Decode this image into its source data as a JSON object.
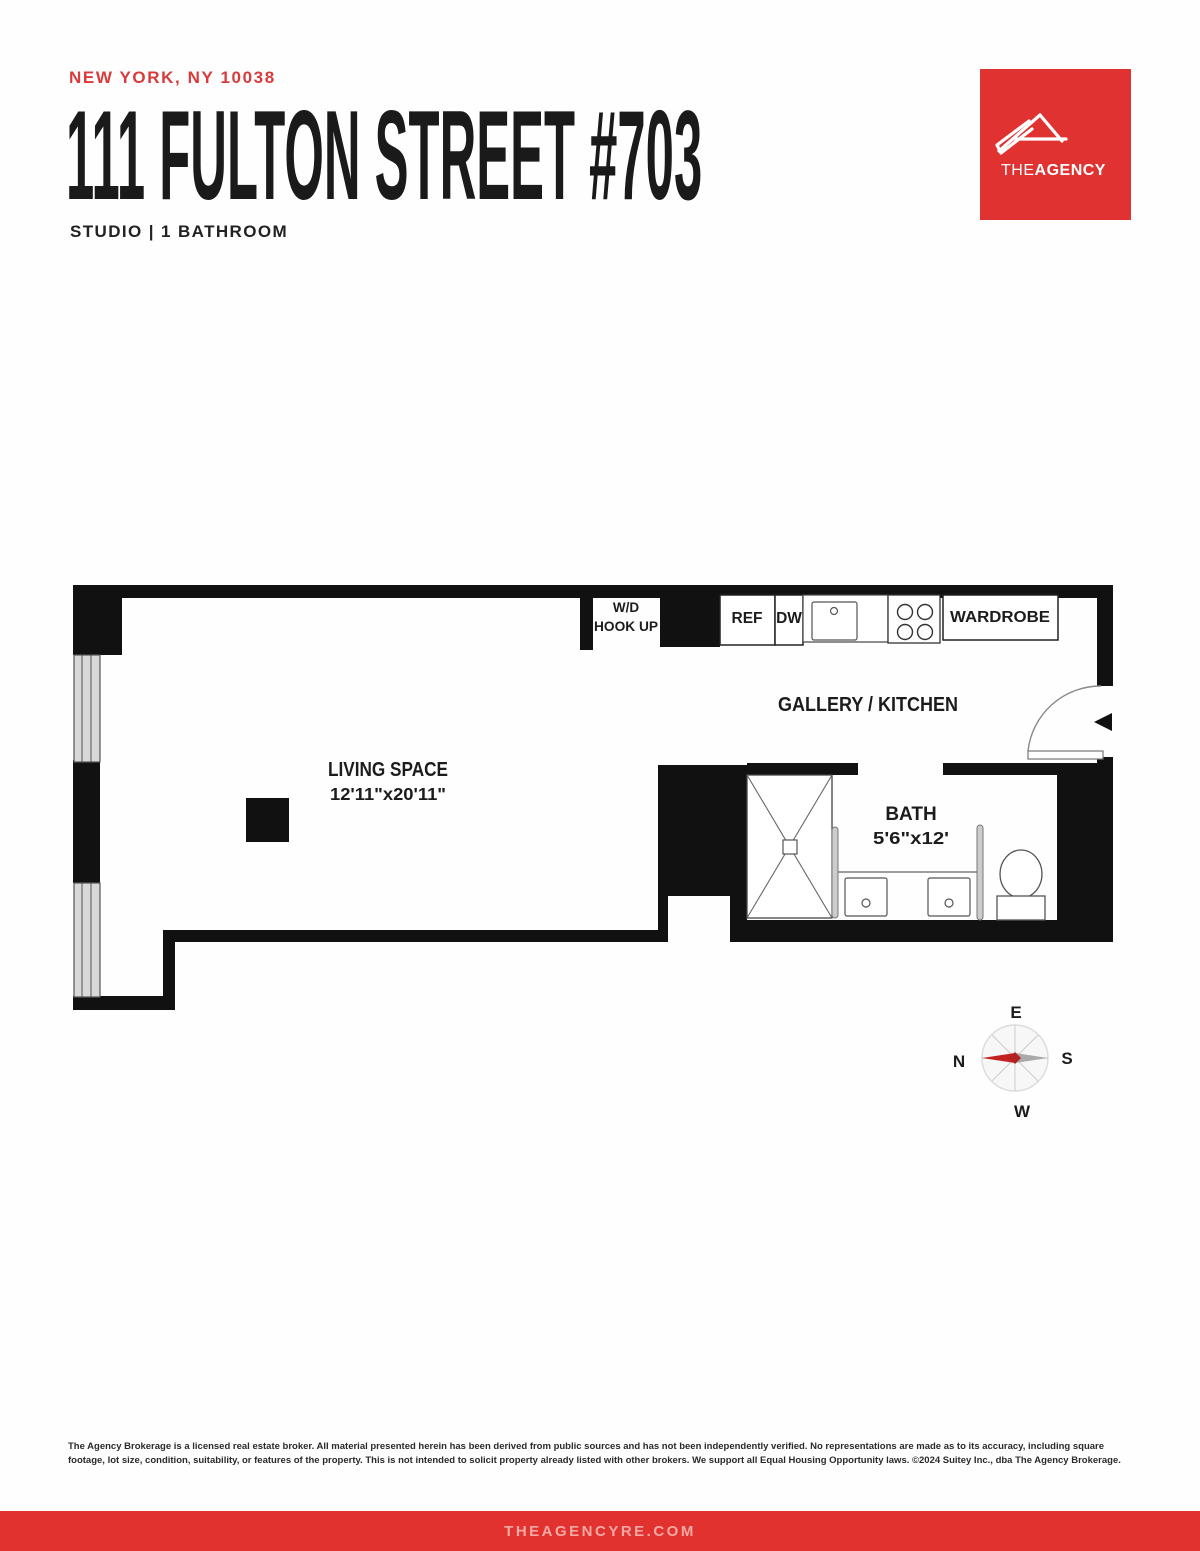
{
  "header": {
    "location": "NEW YORK, NY 10038",
    "title": "111 FULTON STREET #703",
    "subtitle": "STUDIO | 1 BATHROOM"
  },
  "logo": {
    "brand_the": "THE",
    "brand_agency": "AGENCY"
  },
  "floorplan": {
    "labels": {
      "wd_line1": "W/D",
      "wd_line2": "HOOK UP",
      "ref": "REF",
      "dw": "DW",
      "wardrobe": "WARDROBE",
      "gallery_kitchen": "GALLERY / KITCHEN",
      "living_space": "LIVING SPACE",
      "living_dims": "12'11\"x20'11\"",
      "bath": "BATH",
      "bath_dims": "5'6\"x12'"
    },
    "compass": {
      "north": "N",
      "east": "E",
      "south": "S",
      "west": "W"
    }
  },
  "disclaimer": "The Agency Brokerage is a licensed real estate broker. All material presented herein has been derived from public sources and has not been independently verified. No representations are made as to its accuracy, including square footage, lot size, condition, suitability, or features of the property. This is not intended to solicit property already listed with other brokers. We support all Equal Housing Opportunity laws. ©2024 Suitey Inc., dba The Agency Brokerage.",
  "footer": {
    "website": "THEAGENCYRE.COM"
  },
  "colors": {
    "brand_red": "#e03231",
    "header_red": "#d93b3c",
    "footer_text_pink": "#f4a9a5",
    "plan_black": "#111111",
    "window_gray": "#d8d8d8"
  }
}
